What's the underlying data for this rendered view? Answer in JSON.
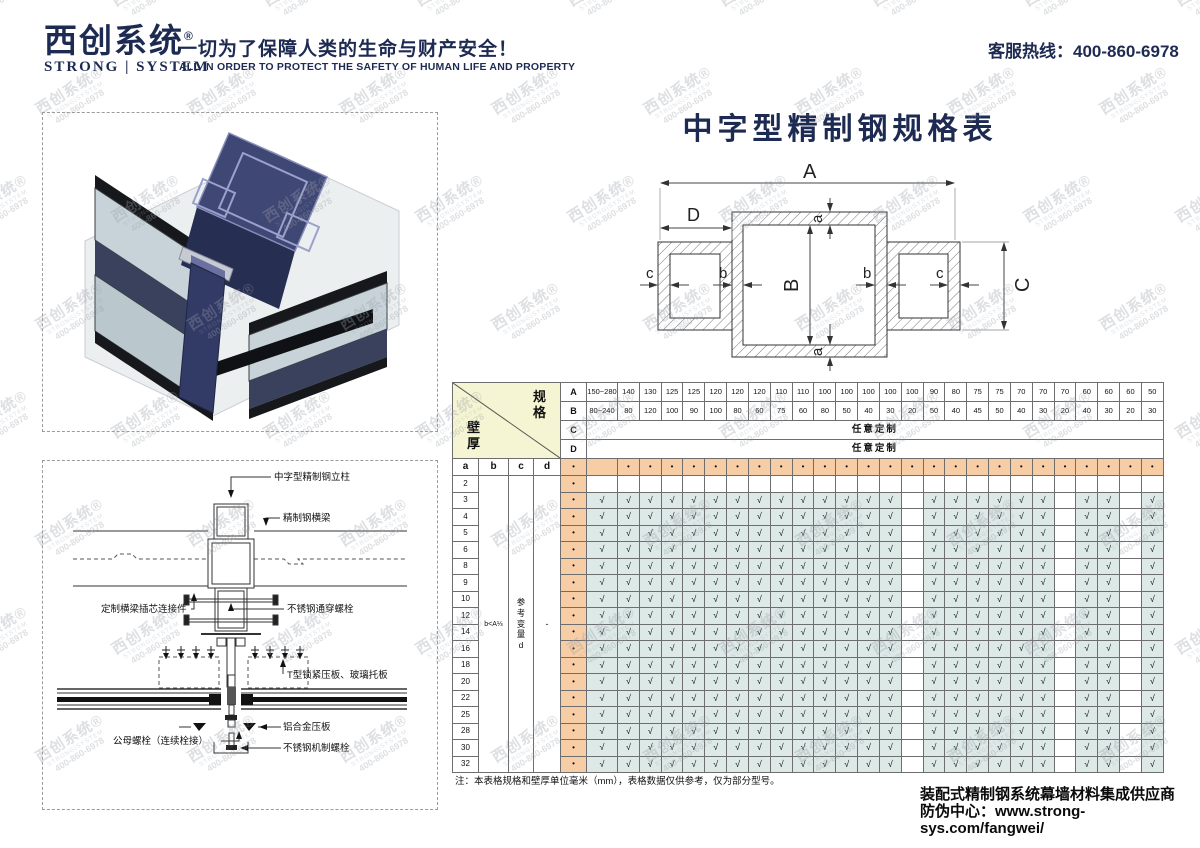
{
  "header": {
    "logo_text": "西创系统",
    "logo_mark": "®",
    "logo_sub": "STRONG | SYSTEM",
    "tagline": "一切为了保障人类的生命与财产安全！",
    "tagline_en": "ALL IN ORDER TO PROTECT THE SAFETY OF HUMAN LIFE AND PROPERTY",
    "hotline": "客服热线：400-860-6978"
  },
  "page_title": "中字型精制钢规格表",
  "watermark": {
    "l1": "西创系统®",
    "l2": "STRONG|SYSTEM",
    "l3": "400-860-6978"
  },
  "diagram": {
    "dims": {
      "A": "A",
      "B": "B",
      "C": "C",
      "D": "D",
      "a": "a",
      "b": "b",
      "c": "c"
    }
  },
  "drawing": {
    "labels": {
      "column": "中字型精制钢立柱",
      "beam": "精制钢横梁",
      "connector": "定制横梁插芯连接件",
      "through_bolt": "不锈钢通穿螺栓",
      "t_plate": "T型锁紧压板、玻璃托板",
      "male_female_bolt": "公母螺栓（连续栓接）",
      "alu_plate": "铝合金压板",
      "machine_bolt": "不锈钢机制螺栓"
    }
  },
  "spec_table": {
    "corner_top": "规格",
    "corner_bottom": "壁厚",
    "row_labels": [
      "A",
      "B",
      "C",
      "D"
    ],
    "spec_A": [
      "150~280",
      "140",
      "130",
      "125",
      "125",
      "120",
      "120",
      "120",
      "110",
      "110",
      "100",
      "100",
      "100",
      "100",
      "100",
      "90",
      "80",
      "75",
      "75",
      "70",
      "70",
      "70",
      "60",
      "60",
      "60",
      "50"
    ],
    "spec_B": [
      "80~240",
      "80",
      "120",
      "100",
      "90",
      "100",
      "80",
      "60",
      "75",
      "60",
      "80",
      "50",
      "40",
      "30",
      "20",
      "50",
      "40",
      "45",
      "50",
      "40",
      "30",
      "20",
      "40",
      "30",
      "20",
      "30"
    ],
    "row_C": "任意定制",
    "row_D": "任意定制",
    "col_headers": [
      "a",
      "b",
      "c",
      "d"
    ],
    "dot": "•",
    "check": "√",
    "rows_a": [
      "2",
      "3",
      "4",
      "5",
      "6",
      "8",
      "9",
      "10",
      "12",
      "14",
      "16",
      "18",
      "20",
      "22",
      "25",
      "28",
      "30",
      "32"
    ],
    "b_note": "b<A⅓",
    "c_note": "参考变量d",
    "d_note": "-",
    "no_check_cols": [
      14,
      21,
      24
    ],
    "note": "注：本表格规格和壁厚单位毫米（mm），表格数据仅供参考，仅为部分型号。"
  },
  "footer": {
    "line1": "装配式精制钢系统幕墙材料集成供应商",
    "line2": "防伪中心：www.strong-sys.com/fangwei/"
  },
  "colors": {
    "navy": "#1d2a52",
    "orange_cell": "#f7cda5",
    "teal_cell": "#dde9e6",
    "corner_yellow": "#f6f5d3"
  }
}
